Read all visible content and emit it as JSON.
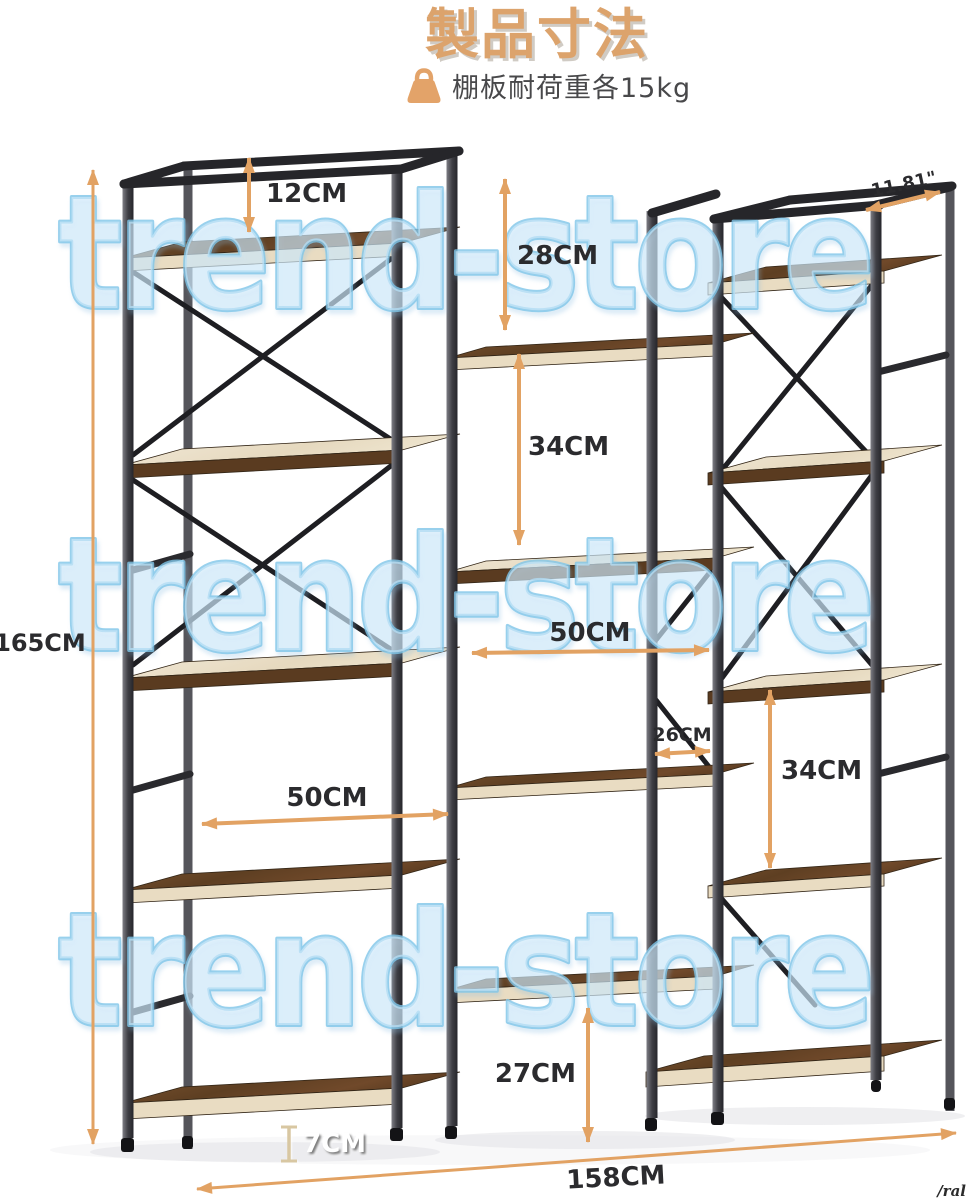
{
  "page": {
    "width": 969,
    "height": 1200,
    "background": "#ffffff"
  },
  "header": {
    "title": "製品寸法",
    "title_color": "#DCA36C",
    "subtitle": "棚板耐荷重各15kg",
    "subtitle_icon": "weight-icon",
    "subtitle_color": "#48484A"
  },
  "watermark": {
    "text": "trend-store",
    "rows": 3,
    "fill": "#D5EDFC",
    "outline": "#7FC5E9"
  },
  "product": {
    "type": "triple-wide industrial bookshelf",
    "frame_color": "#2A2A2E",
    "wood_color": "#6E4A28",
    "wood_edge_color": "#E9DCC2"
  },
  "dimensions": {
    "top_gap": "12CM",
    "upper_middle_gap": "28CM",
    "middle_left_gap": "34CM",
    "middle_width": "50CM",
    "side_gap": "26CM",
    "middle_right_gap": "34CM",
    "left_width": "50CM",
    "bottom_gap": "27CM",
    "floor_clearance": "7CM",
    "total_height": "165CM",
    "total_width": "158CM",
    "depth": "11.81\"",
    "arrow_color": "#E2A263",
    "label_color": "#2B2B2E"
  },
  "corner_note": "/ral"
}
